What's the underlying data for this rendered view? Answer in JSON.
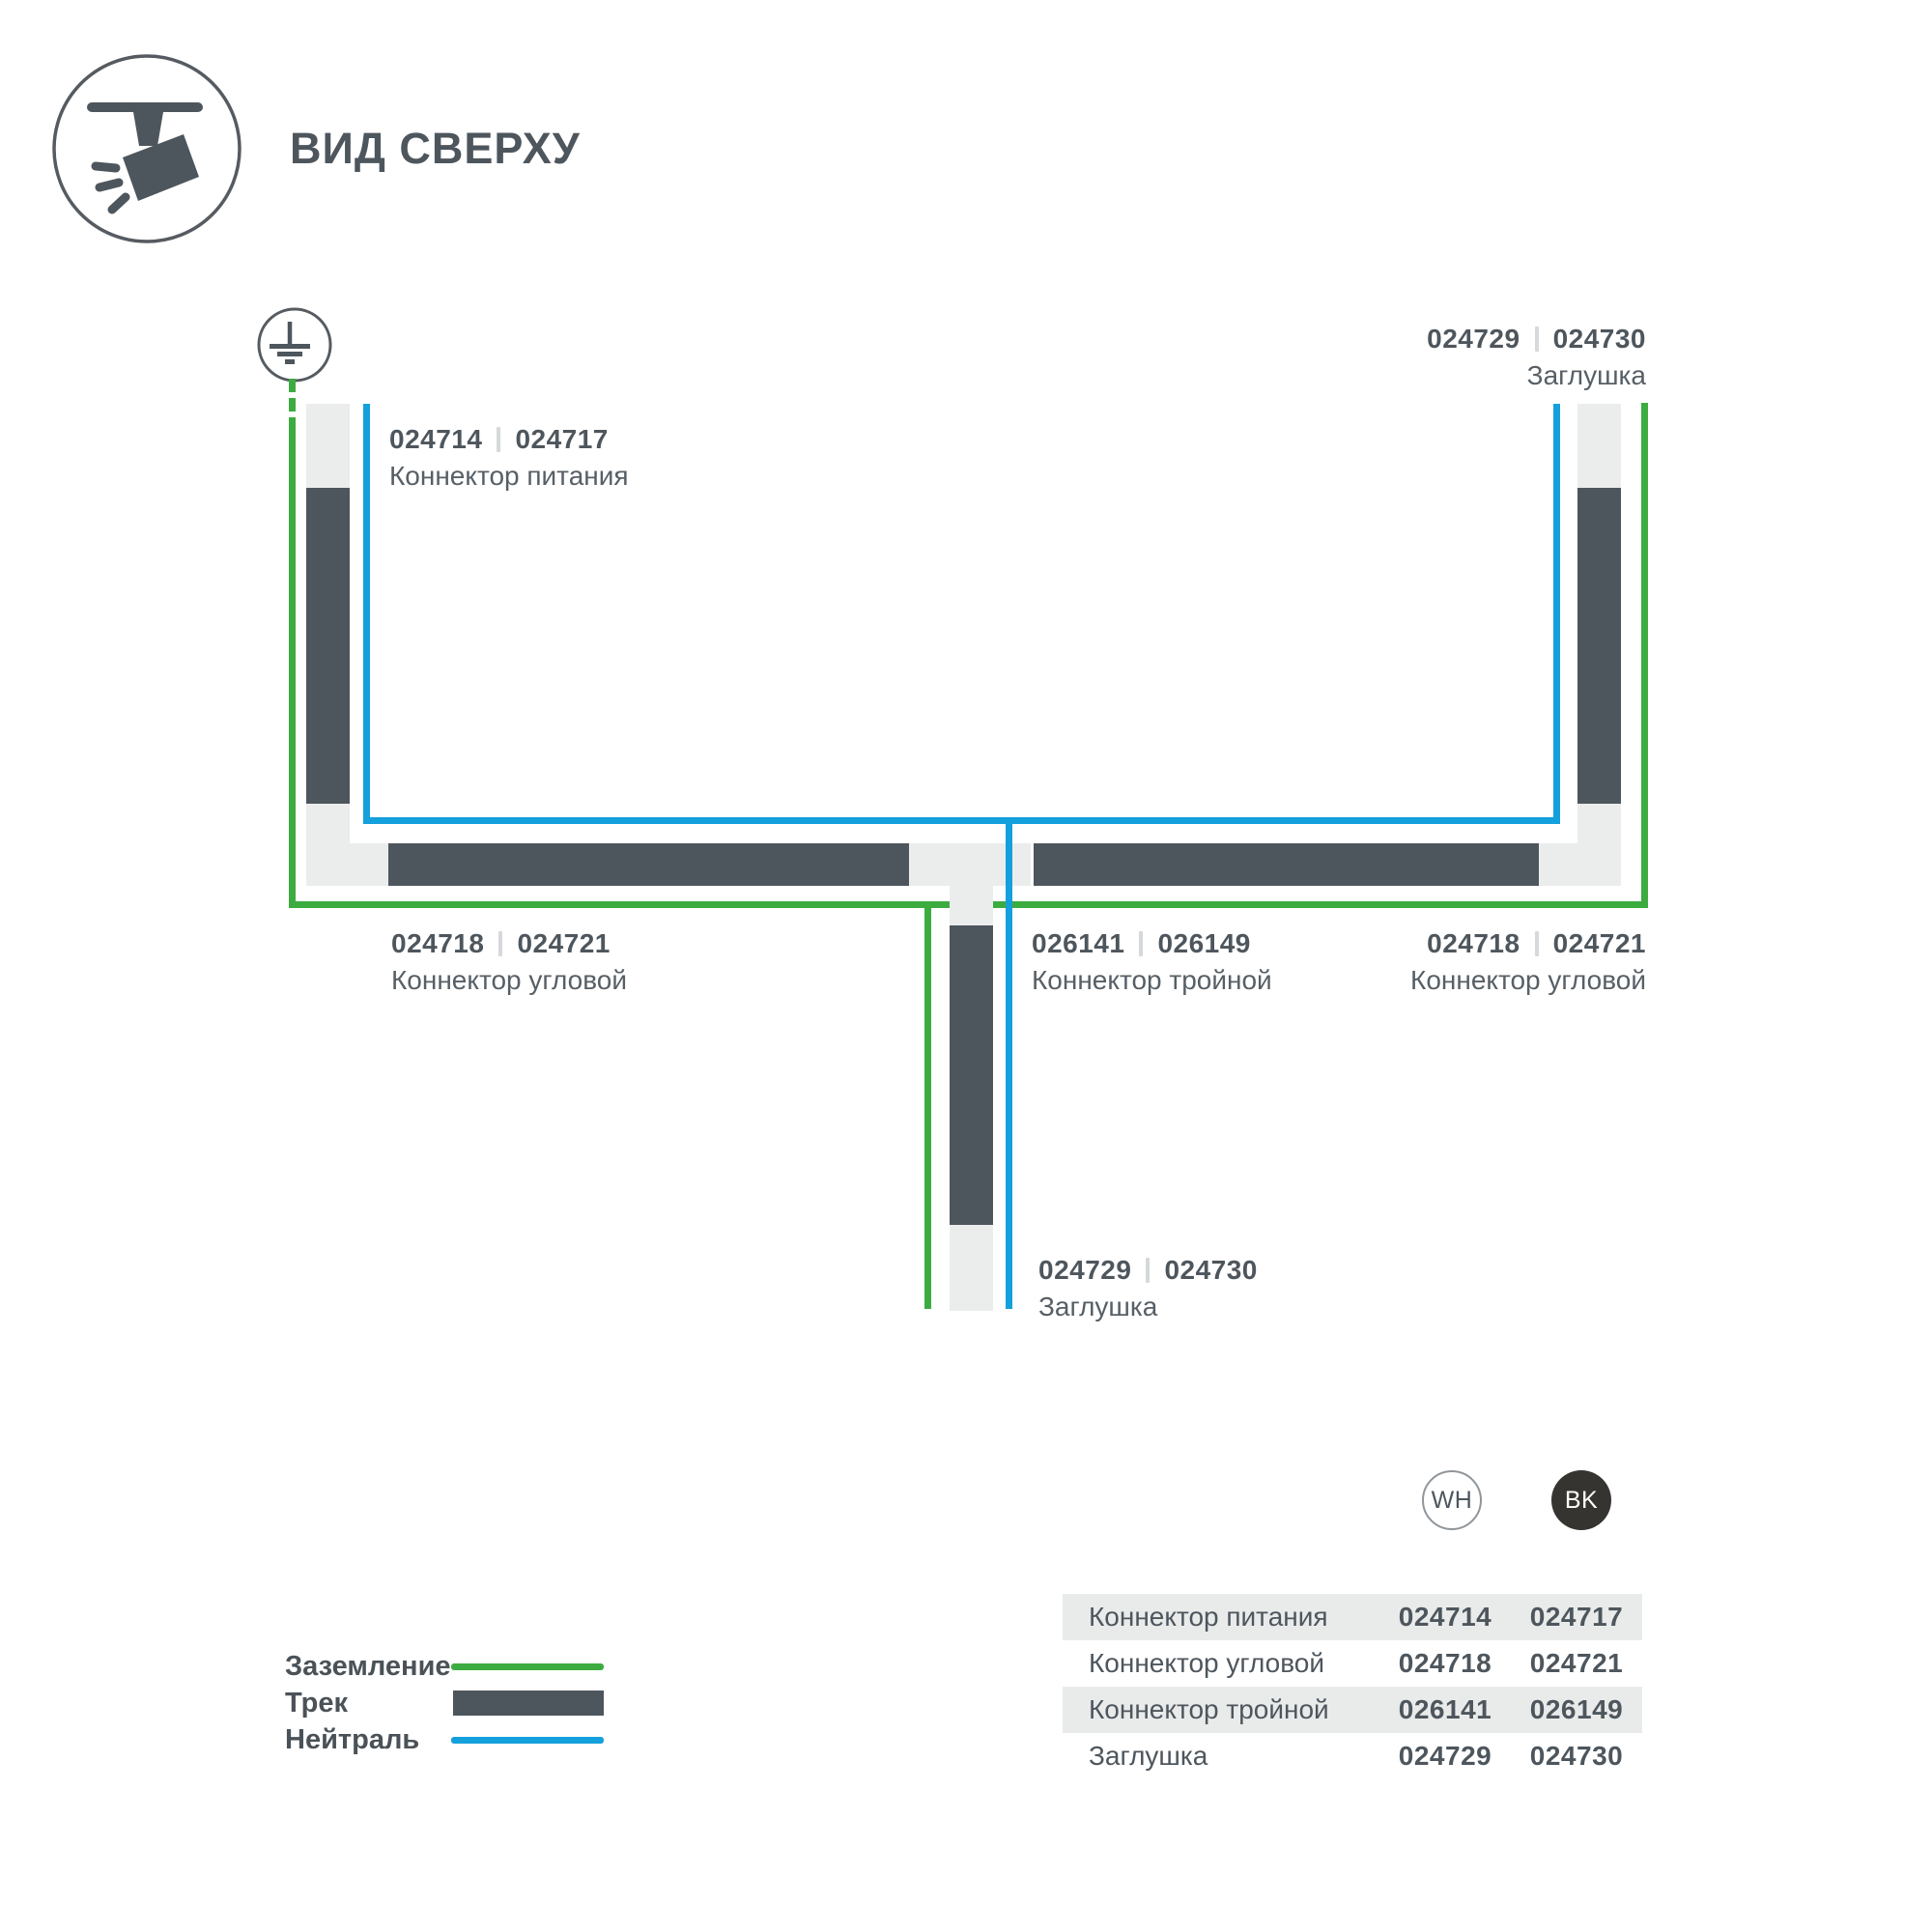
{
  "page": {
    "title": "ВИД СВЕРХУ"
  },
  "colors": {
    "green": "#3CAC40",
    "blue": "#14A0DC",
    "track_dark": "#4E565D",
    "track_light": "#EBEDED",
    "text": "#4E565D",
    "row_shade": "#E9EBEB",
    "bk_fill": "#363430"
  },
  "diagram": {
    "labels": {
      "power": {
        "code_a": "024714",
        "code_b": "024717",
        "name": "Коннектор питания"
      },
      "endcap_top_right": {
        "code_a": "024729",
        "code_b": "024730",
        "name": "Заглушка"
      },
      "corner_bottom_left": {
        "code_a": "024718",
        "code_b": "024721",
        "name": "Коннектор угловой"
      },
      "triple": {
        "code_a": "026141",
        "code_b": "026149",
        "name": "Коннектор тройной"
      },
      "corner_bottom_right": {
        "code_a": "024718",
        "code_b": "024721",
        "name": "Коннектор угловой"
      },
      "endcap_bottom": {
        "code_a": "024729",
        "code_b": "024730",
        "name": "Заглушка"
      }
    }
  },
  "legend": {
    "ground_label": "Заземление",
    "track_label": "Трек",
    "neutral_label": "Нейтраль"
  },
  "variants": {
    "white": "WH",
    "black": "BK"
  },
  "table": {
    "rows": [
      {
        "name": "Коннектор питания",
        "wh": "024714",
        "bk": "024717"
      },
      {
        "name": "Коннектор угловой",
        "wh": "024718",
        "bk": "024721"
      },
      {
        "name": "Коннектор тройной",
        "wh": "026141",
        "bk": "026149"
      },
      {
        "name": "Заглушка",
        "wh": "024729",
        "bk": "024730"
      }
    ]
  }
}
